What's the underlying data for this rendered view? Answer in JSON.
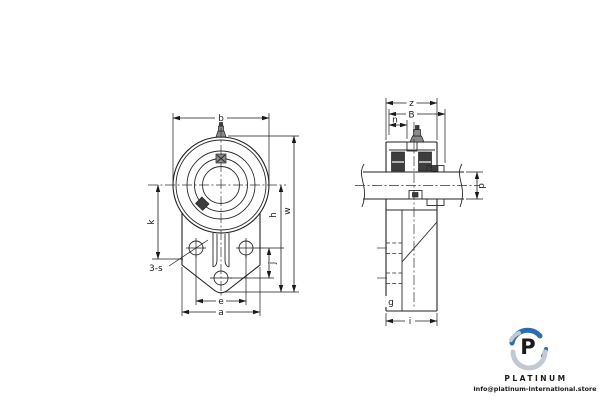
{
  "drawing": {
    "line_color": "#222222",
    "front_view": {
      "labels": {
        "b": "b",
        "k": "k",
        "h": "h",
        "w": "w",
        "j": "j",
        "e": "e",
        "a": "a",
        "screw_callout": "3-s"
      }
    },
    "side_view": {
      "labels": {
        "z": "z",
        "B": "B",
        "n": "n",
        "p": "p",
        "g": "g",
        "i": "i"
      }
    }
  },
  "logo": {
    "monogram": "P",
    "brand": "PLATINUM",
    "email": "info@platinum-international.store",
    "blue": "#2d6cad",
    "gray": "#c3c9d2",
    "text_color": "#16355a",
    "email_color": "#1c2533"
  }
}
